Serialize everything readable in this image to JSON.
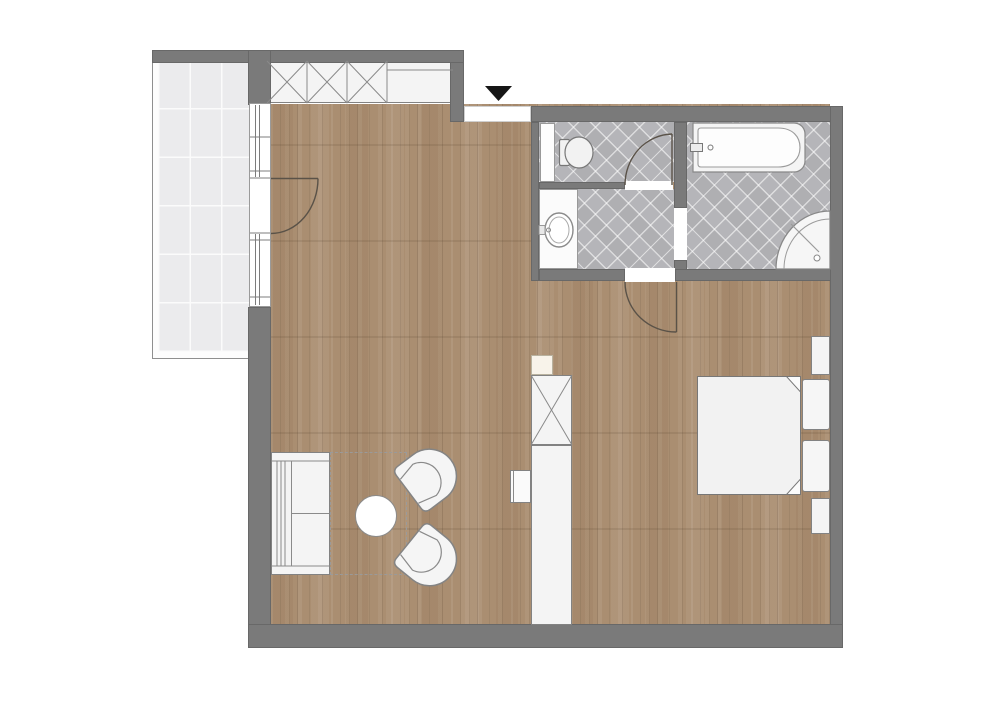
{
  "floor_plan": {
    "type": "apartment-floor-plan",
    "rooms": [
      "balcony",
      "living-area",
      "sleeping-area",
      "entry",
      "wc",
      "shower-room",
      "bathroom"
    ],
    "furniture": [
      "built-in-closet",
      "sofa",
      "coffee-table",
      "tub-armchair-upper",
      "tub-armchair-lower",
      "partition-wardrobe",
      "wall-shelf",
      "double-bed",
      "pillow-upper",
      "pillow-lower",
      "nightstand-upper",
      "nightstand-lower"
    ],
    "fixtures": [
      "toilet",
      "duct-shaft",
      "washbasin",
      "bathtub",
      "corner-shower"
    ],
    "doors": [
      "entry-door",
      "balcony-door",
      "wc-door",
      "bathroom-door",
      "shower-room-passage"
    ],
    "entry_marker": "triangle-down"
  },
  "colors": {
    "bg": "#ffffff",
    "wall": "#7a7a7a",
    "wood": "#aa8e71",
    "tile": "#b5b5b9",
    "balconyTile": "#ebebed",
    "balconyLine": "#fbfbfb",
    "fixtureFill": "#f4f4f4",
    "fixtureStroke": "#828282",
    "doorArc": "#5a5248",
    "marker": "#161616",
    "rugDash": "#9a9a9a"
  }
}
